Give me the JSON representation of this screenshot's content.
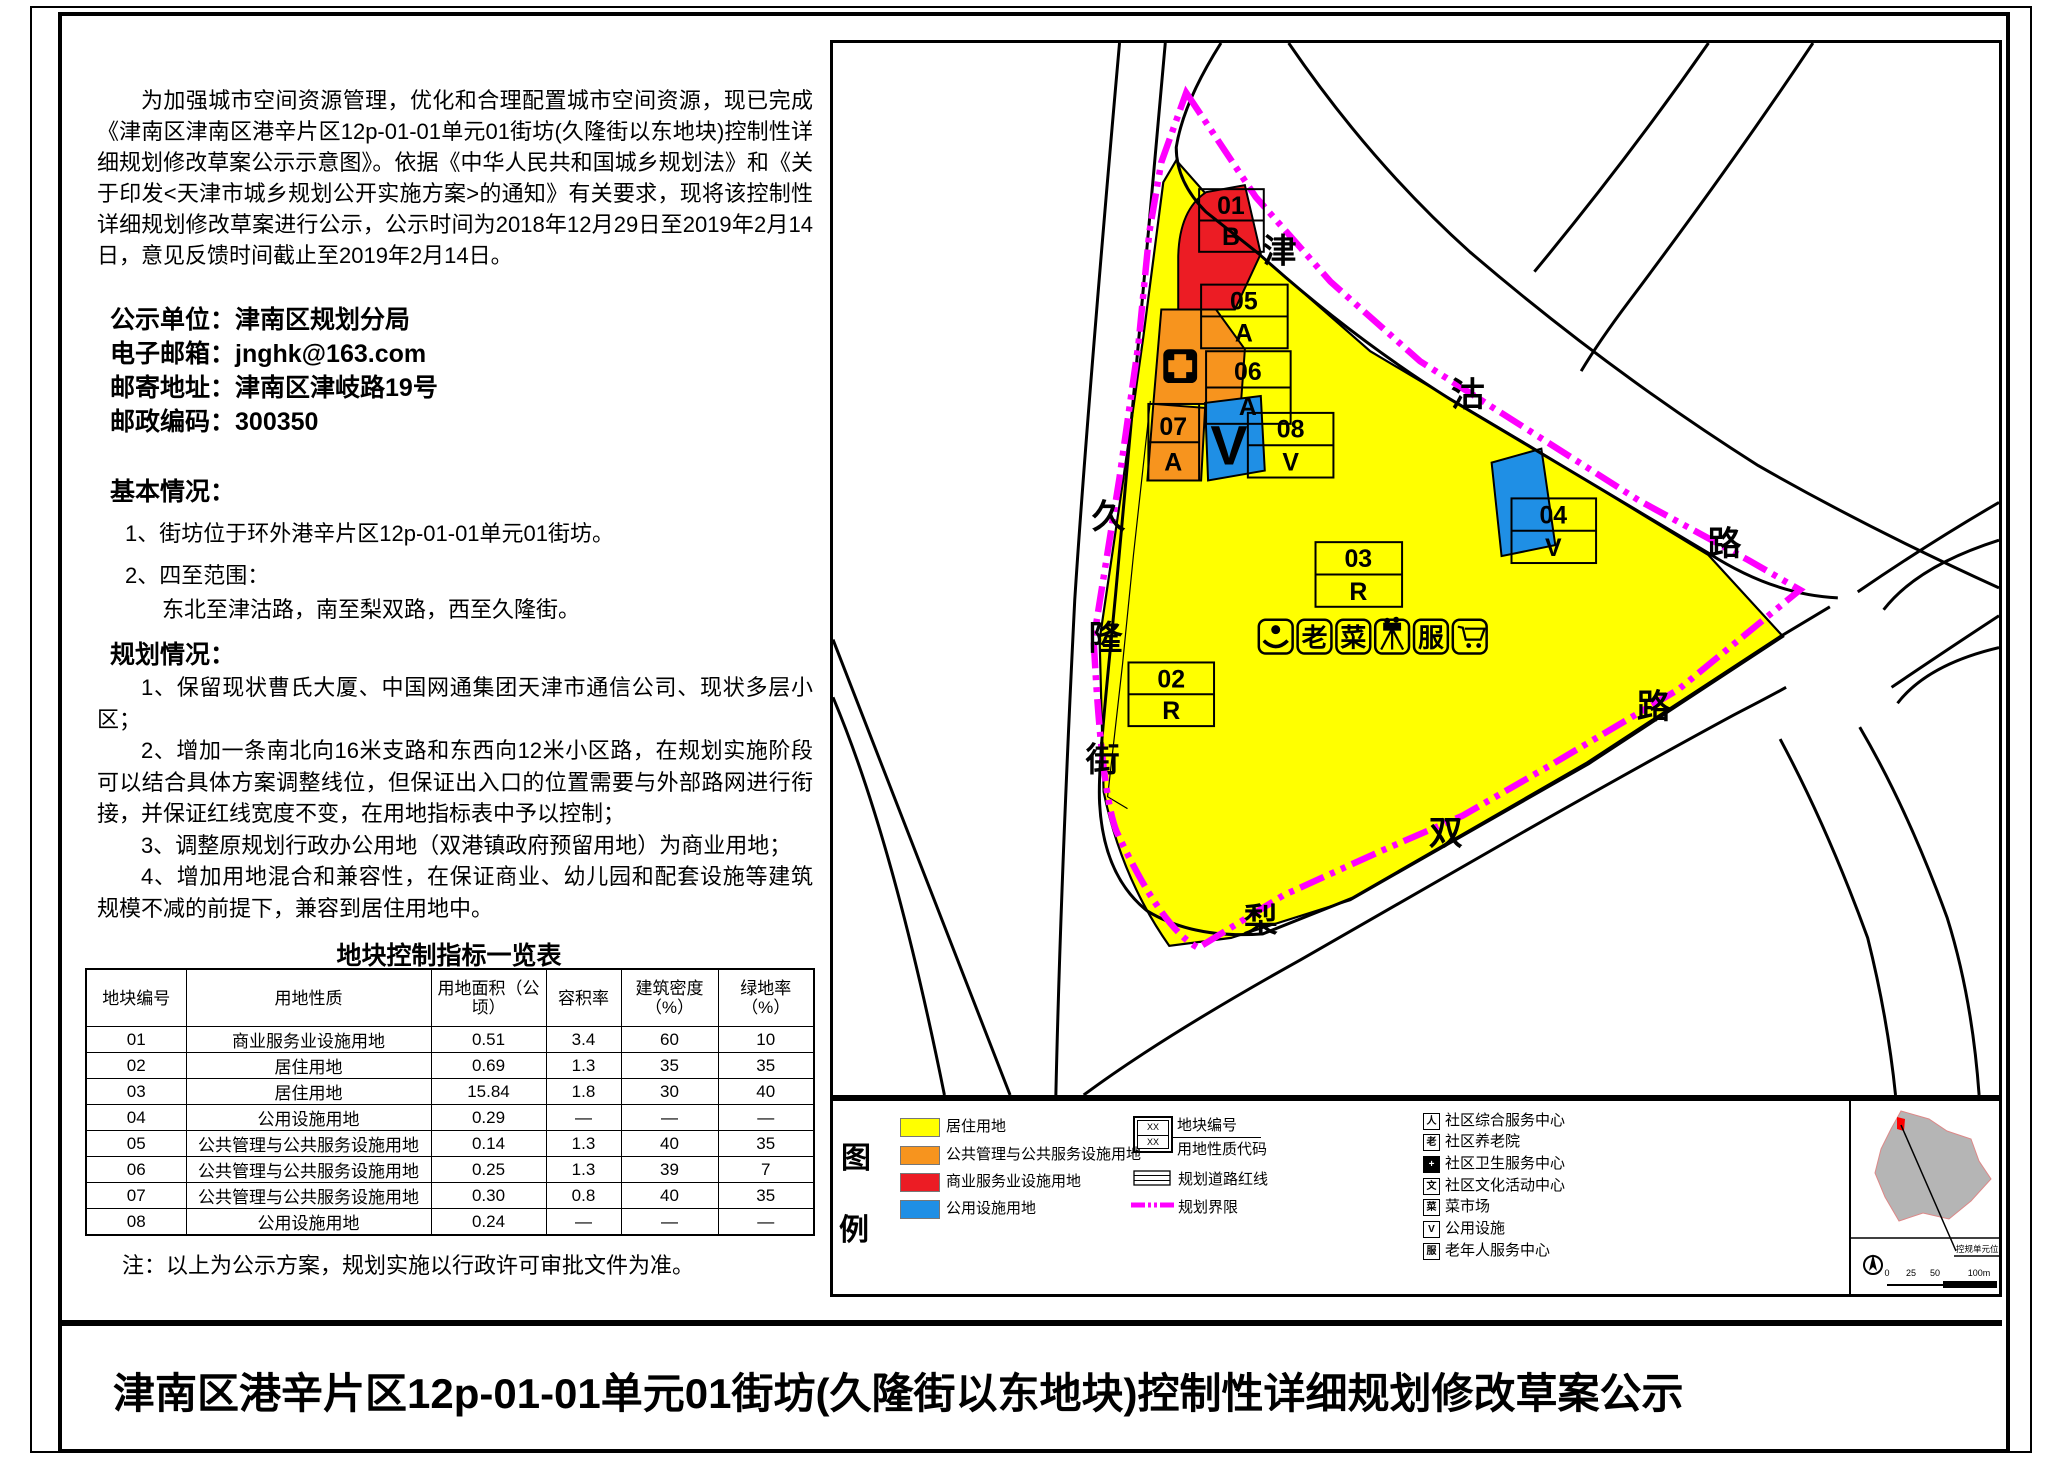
{
  "page": {
    "title_bar": "津南区港辛片区12p-01-01单元01街坊(久隆街以东地块)控制性详细规划修改草案公示"
  },
  "notice": {
    "intro": "为加强城市空间资源管理，优化和合理配置城市空间资源，现已完成《津南区津南区港辛片区12p-01-01单元01街坊(久隆街以东地块)控制性详细规划修改草案公示示意图》。依据《中华人民共和国城乡规划法》和《关于印发<天津市城乡规划公开实施方案>的通知》有关要求，现将该控制性详细规划修改草案进行公示，公示时间为2018年12月29日至2019年2月14日，意见反馈时间截止至2019年2月14日。",
    "contact": [
      {
        "label": "公示单位：",
        "value": "津南区规划分局"
      },
      {
        "label": "电子邮箱：",
        "value": "jnghk@163.com"
      },
      {
        "label": "邮寄地址：",
        "value": "津南区津岐路19号"
      },
      {
        "label": "邮政编码：",
        "value": "300350"
      }
    ],
    "basic": {
      "title": "基本情况：",
      "item1": "1、街坊位于环外港辛片区12p-01-01单元01街坊。",
      "item2": "2、四至范围：",
      "item2_detail": "东北至津沽路，南至梨双路，西至久隆街。"
    },
    "planning": {
      "title": "规划情况：",
      "items": [
        "1、保留现状曹氏大厦、中国网通集团天津市通信公司、现状多层小区；",
        "2、增加一条南北向16米支路和东西向12米小区路，在规划实施阶段可以结合具体方案调整线位，但保证出入口的位置需要与外部路网进行衔接，并保证红线宽度不变，在用地指标表中予以控制；",
        "3、调整原规划行政办公用地（双港镇政府预留用地）为商业用地；",
        "4、增加用地混合和兼容性，在保证商业、幼儿园和配套设施等建筑规模不减的前提下，兼容到居住用地中。"
      ]
    },
    "note": "注：以上为公示方案，规划实施以行政许可审批文件为准。"
  },
  "table": {
    "title": "地块控制指标一览表",
    "headers": [
      "地块编号",
      "用地性质",
      "用地面积（公顷）",
      "容积率",
      "建筑密度（%）",
      "绿地率（%）"
    ],
    "rows": [
      [
        "01",
        "商业服务业设施用地",
        "0.51",
        "3.4",
        "60",
        "10"
      ],
      [
        "02",
        "居住用地",
        "0.69",
        "1.3",
        "35",
        "35"
      ],
      [
        "03",
        "居住用地",
        "15.84",
        "1.8",
        "30",
        "40"
      ],
      [
        "04",
        "公用设施用地",
        "0.29",
        "—",
        "—",
        "—"
      ],
      [
        "05",
        "公共管理与公共服务设施用地",
        "0.14",
        "1.3",
        "40",
        "35"
      ],
      [
        "06",
        "公共管理与公共服务设施用地",
        "0.25",
        "1.3",
        "39",
        "7"
      ],
      [
        "07",
        "公共管理与公共服务设施用地",
        "0.30",
        "0.8",
        "40",
        "35"
      ],
      [
        "08",
        "公用设施用地",
        "0.24",
        "—",
        "—",
        "—"
      ]
    ]
  },
  "map": {
    "road_chars": [
      "津",
      "沽",
      "路",
      "双",
      "路",
      "梨",
      "久",
      "隆",
      "街"
    ],
    "plots": [
      {
        "code": "01",
        "type": "B"
      },
      {
        "code": "05",
        "type": "A"
      },
      {
        "code": "06",
        "type": "A"
      },
      {
        "code": "07",
        "type": "A"
      },
      {
        "code": "08",
        "type": "V"
      },
      {
        "code": "04",
        "type": "V"
      },
      {
        "code": "03",
        "type": "R"
      },
      {
        "code": "02",
        "type": "R"
      }
    ],
    "blue_v_glyph": "V",
    "facility_glyphs": {
      "elderly": "老",
      "market": "菜",
      "service": "服"
    },
    "colors": {
      "residential": "#FFFF00",
      "public_mgmt": "#F7941E",
      "commercial": "#EC1C24",
      "utility": "#1F8FE5",
      "boundary": "#FF00FF",
      "inset_gray": "#B5B5B5"
    }
  },
  "legend": {
    "title_top": "图",
    "title_bottom": "例",
    "landuse": [
      {
        "label": "居住用地"
      },
      {
        "label": "公共管理与公共服务设施用地"
      },
      {
        "label": "商业服务业设施用地"
      },
      {
        "label": "公用设施用地"
      }
    ],
    "plot_symbol": {
      "top": "XX",
      "bottom": "XX",
      "label_top": "地块编号",
      "label_bottom": "用地性质代码"
    },
    "road_redline_label": "规划道路红线",
    "boundary_label": "规划界限",
    "facilities": [
      {
        "glyph": "人",
        "label": "社区综合服务中心"
      },
      {
        "glyph": "老",
        "label": "社区养老院"
      },
      {
        "glyph": "+",
        "label": "社区卫生服务中心"
      },
      {
        "glyph": "文",
        "label": "社区文化活动中心"
      },
      {
        "glyph": "菜",
        "label": "菜市场"
      },
      {
        "glyph": "V",
        "label": "公用设施"
      },
      {
        "glyph": "服",
        "label": "老年人服务中心"
      }
    ]
  },
  "inset": {
    "label": "控规单元位置",
    "scale": {
      "t0": "0",
      "t1": "25",
      "t2": "50",
      "t3": "100m"
    }
  }
}
